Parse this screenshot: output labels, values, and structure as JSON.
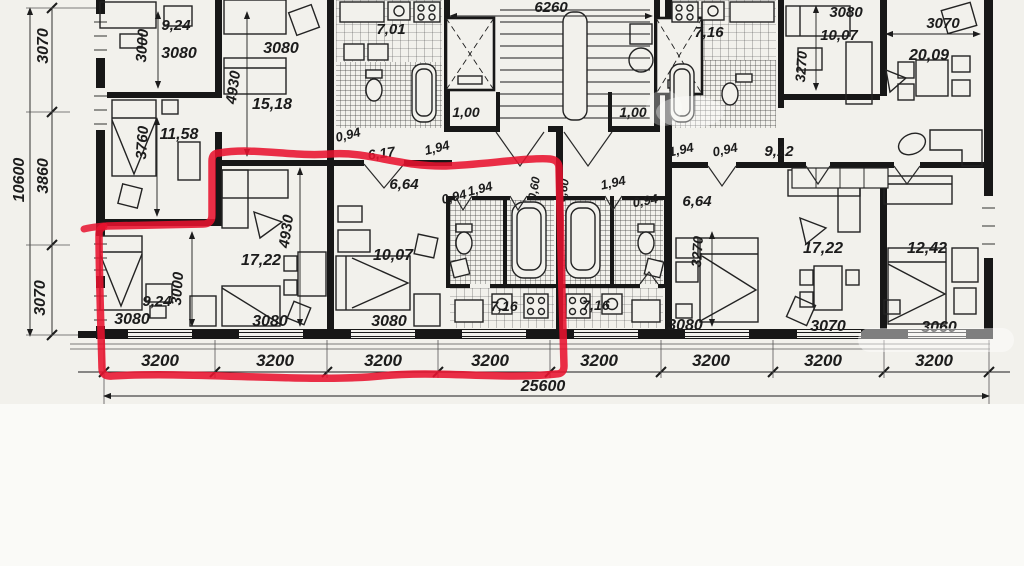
{
  "document": {
    "type": "floor-plan-scan",
    "paper_color": "#f2f1ec",
    "ink_color": "#1c1c1c",
    "highlight_color": "#e8122f",
    "highlight_meaning": "selected apartment outline"
  },
  "labels": [
    {
      "id": "dim-left-overall",
      "text": "10600"
    },
    {
      "id": "dim-left-1",
      "text": "3070"
    },
    {
      "id": "dim-left-2",
      "text": "3860"
    },
    {
      "id": "dim-left-3",
      "text": "3070"
    },
    {
      "id": "area-tl-1",
      "text": "9,24"
    },
    {
      "id": "dim-tl-1",
      "text": "3080"
    },
    {
      "id": "dim-tl-v1",
      "text": "3000"
    },
    {
      "id": "dim-tl-v2",
      "text": "3760"
    },
    {
      "id": "area-tl-2",
      "text": "11,58"
    },
    {
      "id": "dim-tl-v3",
      "text": "4930"
    },
    {
      "id": "area-tl-3",
      "text": "15,18"
    },
    {
      "id": "dim-tl-2",
      "text": "3080"
    },
    {
      "id": "area-kitchen-tl",
      "text": "7,01"
    },
    {
      "id": "dim-hall-tl-1",
      "text": "0,94"
    },
    {
      "id": "area-hall-tl",
      "text": "6,17"
    },
    {
      "id": "dim-hall-tl-2",
      "text": "1,94"
    },
    {
      "id": "dim-stair-width",
      "text": "6260"
    },
    {
      "id": "area-vestibule-left",
      "text": "1,00"
    },
    {
      "id": "area-vestibule-right",
      "text": "1,00"
    },
    {
      "id": "dim-hall-tr-1",
      "text": "1,94"
    },
    {
      "id": "dim-hall-tr-2",
      "text": "0,94"
    },
    {
      "id": "area-hall-tr",
      "text": "9,12"
    },
    {
      "id": "area-kitchen-tr",
      "text": "7,16"
    },
    {
      "id": "dim-tr-1",
      "text": "3080"
    },
    {
      "id": "area-tr-1",
      "text": "10,07"
    },
    {
      "id": "dim-tr-v1",
      "text": "3270"
    },
    {
      "id": "dim-tr-2",
      "text": "3070"
    },
    {
      "id": "area-tr-2",
      "text": "20,09"
    },
    {
      "id": "area-hall-red",
      "text": "6,64"
    },
    {
      "id": "dim-hall-red-1",
      "text": "0,94"
    },
    {
      "id": "dim-hall-red-2",
      "text": "1,94"
    },
    {
      "id": "dim-bath-red-1",
      "text": "0,60"
    },
    {
      "id": "dim-bath-red-2",
      "text": "0,60"
    },
    {
      "id": "dim-hall-r2-1",
      "text": "1,94"
    },
    {
      "id": "dim-hall-r2-2",
      "text": "0,94"
    },
    {
      "id": "area-hall-r2",
      "text": "6,64"
    },
    {
      "id": "area-red-living",
      "text": "17,22"
    },
    {
      "id": "dim-red-v1",
      "text": "4930"
    },
    {
      "id": "dim-red-v2",
      "text": "3000"
    },
    {
      "id": "area-red-bed1",
      "text": "9,24"
    },
    {
      "id": "area-red-bed2",
      "text": "10,07"
    },
    {
      "id": "dim-r2-v1",
      "text": "3270"
    },
    {
      "id": "area-r2-living",
      "text": "17,22"
    },
    {
      "id": "area-r3-bed",
      "text": "12,42"
    },
    {
      "id": "dim-b-room1",
      "text": "3080"
    },
    {
      "id": "dim-b-room2",
      "text": "3080"
    },
    {
      "id": "dim-b-room3",
      "text": "3080"
    },
    {
      "id": "area-kitchen-red",
      "text": "7,16"
    },
    {
      "id": "area-kitchen-r2",
      "text": "7,16"
    },
    {
      "id": "dim-b-room4",
      "text": "3080"
    },
    {
      "id": "dim-b-room5",
      "text": "3070"
    },
    {
      "id": "dim-b-room6",
      "text": "3060"
    },
    {
      "id": "dim-bay-1",
      "text": "3200"
    },
    {
      "id": "dim-bay-2",
      "text": "3200"
    },
    {
      "id": "dim-bay-3",
      "text": "3200"
    },
    {
      "id": "dim-bay-4",
      "text": "3200"
    },
    {
      "id": "dim-bay-5",
      "text": "3200"
    },
    {
      "id": "dim-bay-6",
      "text": "3200"
    },
    {
      "id": "dim-bay-7",
      "text": "3200"
    },
    {
      "id": "dim-bay-8",
      "text": "3200"
    },
    {
      "id": "dim-overall-bottom",
      "text": "25600"
    }
  ]
}
